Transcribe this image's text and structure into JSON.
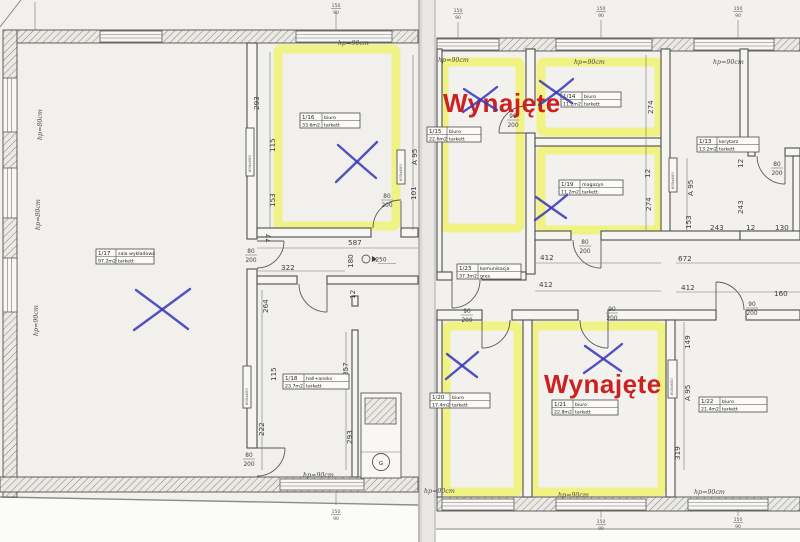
{
  "rooms": [
    {
      "id": "1/17",
      "name": "sala wykładowa",
      "area": "97.2m2",
      "floor": "tarkett"
    },
    {
      "id": "1/16",
      "name": "biuro",
      "area": "33.6m2",
      "floor": "tarkett"
    },
    {
      "id": "1/15",
      "name": "biuro",
      "area": "22.6m2",
      "floor": "tarkett"
    },
    {
      "id": "1/14",
      "name": "biuro",
      "area": "11.2m2",
      "floor": "tarkett"
    },
    {
      "id": "1/13",
      "name": "korytarz",
      "area": "13.2m2",
      "floor": "tarkett"
    },
    {
      "id": "1/19",
      "name": "magazyn",
      "area": "11.2m2",
      "floor": "tarkett"
    },
    {
      "id": "1/23",
      "name": "komunikacja",
      "area": "37.3m2",
      "floor": "gres"
    },
    {
      "id": "1/18",
      "name": "hall+aneks",
      "area": "23.7m2",
      "floor": "tarkett"
    },
    {
      "id": "1/20",
      "name": "biuro",
      "area": "17.4m2",
      "floor": "tarkett"
    },
    {
      "id": "1/21",
      "name": "biuro",
      "area": "22.8m2",
      "floor": "tarkett"
    },
    {
      "id": "1/22",
      "name": "biuro",
      "area": "21.4m2",
      "floor": "tarkett"
    }
  ],
  "rented_labels": [
    "Wynajęte",
    "Wynajęte"
  ],
  "dims": [
    "293",
    "115",
    "153",
    "A 95",
    "101",
    "587",
    "180",
    "322",
    "77",
    "12",
    "264",
    "257",
    "115",
    "222",
    "293",
    "274",
    "12",
    "274",
    "A 95",
    "12",
    "243",
    "153",
    "243",
    "12",
    "130",
    "672",
    "412",
    "412",
    "412",
    "160",
    "149",
    "A 95",
    "319"
  ],
  "door_sizes": [
    {
      "w": "80",
      "h": "200"
    },
    {
      "w": "80",
      "h": "200"
    },
    {
      "w": "90",
      "h": "200"
    },
    {
      "w": "80",
      "h": "200"
    },
    {
      "w": "80",
      "h": "200"
    },
    {
      "w": "90",
      "h": "200"
    },
    {
      "w": "90",
      "h": "200"
    },
    {
      "w": "90",
      "h": "200"
    },
    {
      "w": "80",
      "h": "200"
    }
  ],
  "window_labels": [
    "hp=90cm",
    "hp=80cm",
    "hp=80cm",
    "hp=90cm",
    "hp=90cm",
    "hp=90cm",
    "hp=90cm",
    "hp=90cm",
    "hp=90cm",
    "hp=90cm",
    "hp=90cm"
  ],
  "window_size": {
    "t": "150",
    "b": "90"
  },
  "fixtures": {
    "radiator": "600x600",
    "gas": "G",
    "drain": "A250"
  },
  "colors": {
    "highlight": "#eef25c",
    "rented": "#cb2121",
    "pen": "#3a3ab8",
    "paper": "#f1f0ec"
  }
}
